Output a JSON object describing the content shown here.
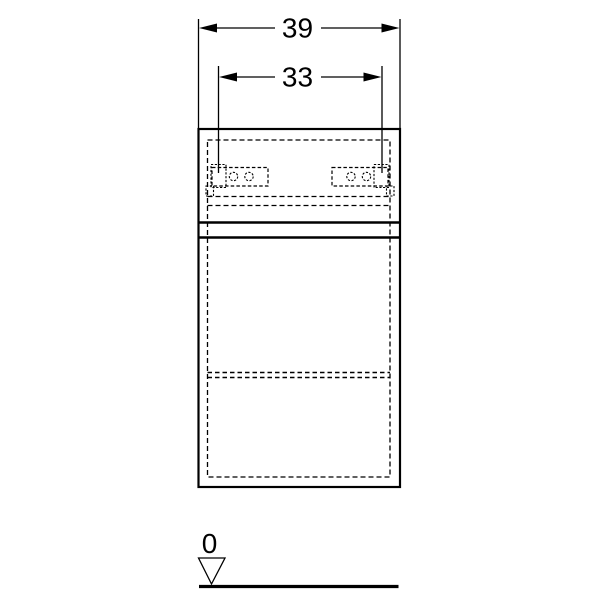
{
  "drawing": {
    "dimensions": {
      "outer_width_label": "39",
      "hinge_spacing_label": "33",
      "floor_datum_label": "0"
    },
    "colors": {
      "line": "#000000",
      "background": "#ffffff"
    }
  }
}
